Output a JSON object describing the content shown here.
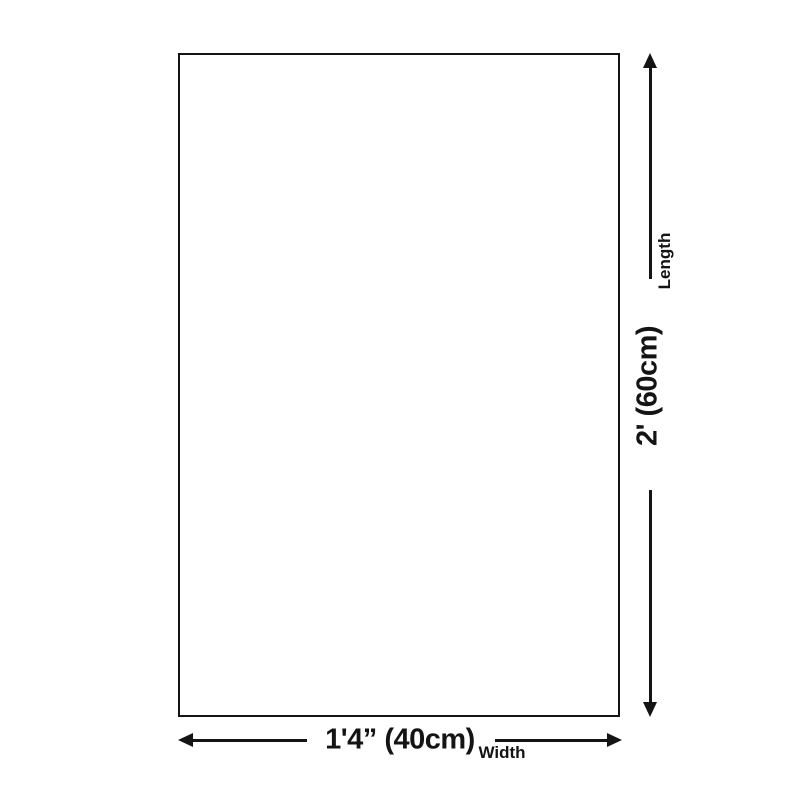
{
  "colors": {
    "background": "#ffffff",
    "ink": "#141414"
  },
  "diagram": {
    "vertical_dimension": {
      "label": "Length",
      "value": "2' (60cm)"
    },
    "horizontal_dimension": {
      "label": "Width",
      "value": "1'4” (40cm)"
    }
  }
}
